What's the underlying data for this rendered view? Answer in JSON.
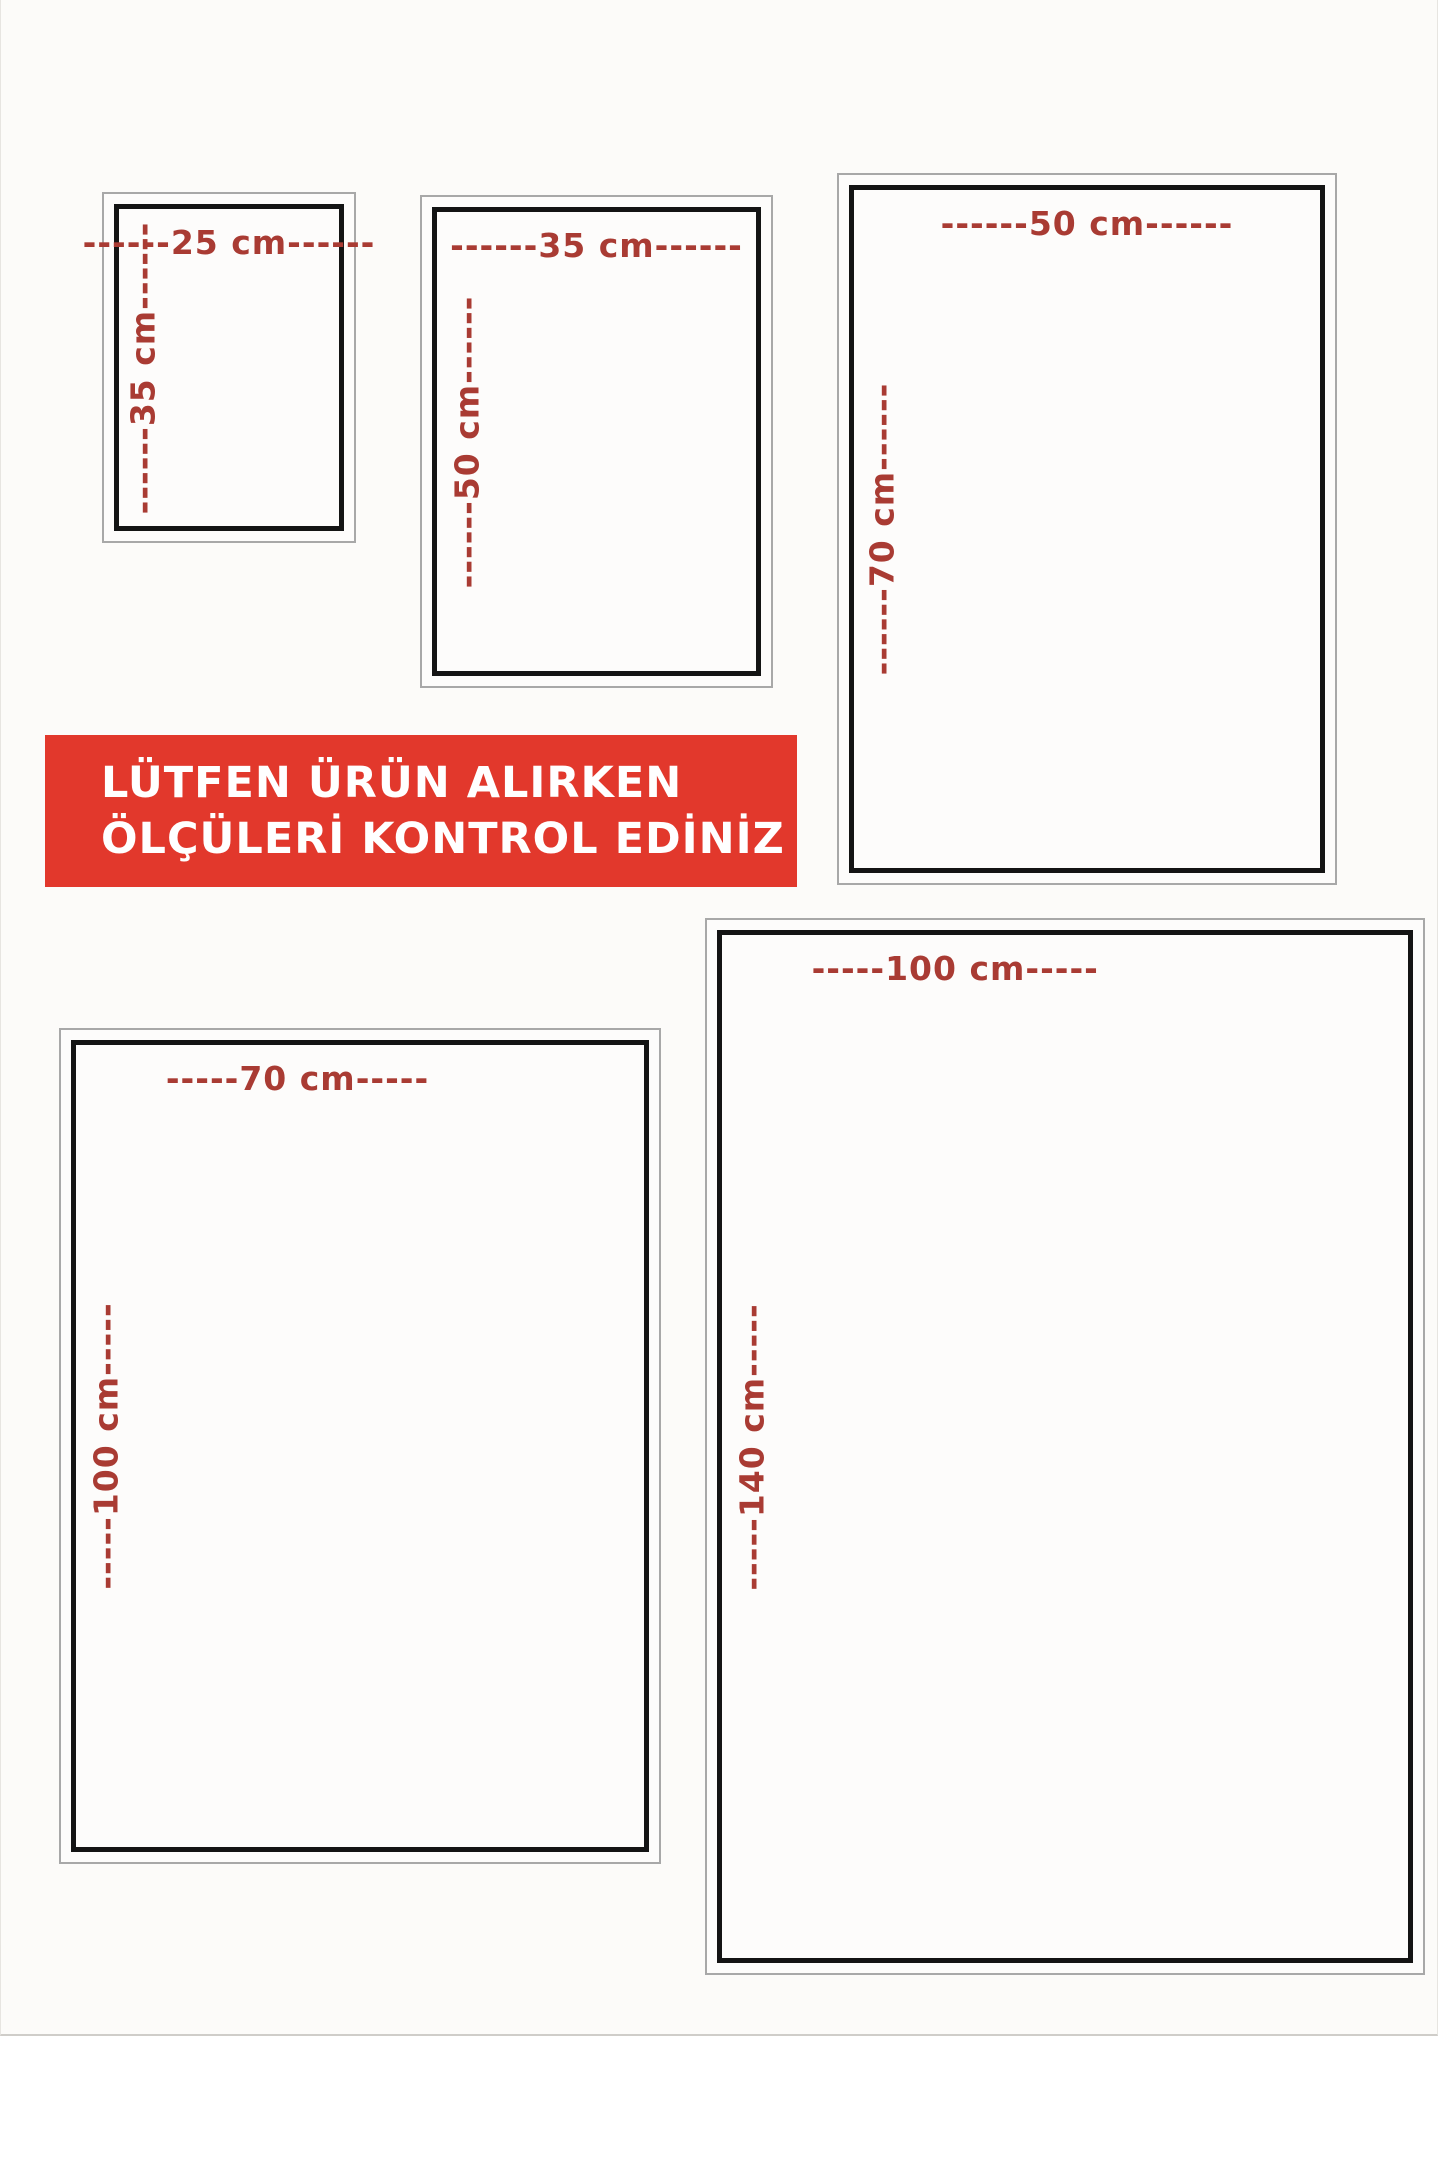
{
  "banner": {
    "line1": "LÜTFEN ÜRÜN ALIRKEN",
    "line2": "ÖLÇÜLERİ KONTROL EDİNİZ"
  },
  "colors": {
    "banner_red": "#e2382c",
    "banner_text": "#ffffff",
    "label_red": "#a93b33",
    "box_border_black": "#141414",
    "box_frame_gray": "#a8a8a8",
    "page_bg": "#fcfbf9"
  },
  "sizes": [
    {
      "name": "25x35",
      "width_cm": 25,
      "height_cm": 35,
      "width_label": "------25 cm------",
      "height_label": "------35 cm------"
    },
    {
      "name": "35x50",
      "width_cm": 35,
      "height_cm": 50,
      "width_label": "------35 cm------",
      "height_label": "------50 cm------"
    },
    {
      "name": "50x70",
      "width_cm": 50,
      "height_cm": 70,
      "width_label": "------50 cm------",
      "height_label": "------70 cm------"
    },
    {
      "name": "70x100",
      "width_cm": 70,
      "height_cm": 100,
      "width_label": "-----70 cm-----",
      "height_label": "-----100 cm-----"
    },
    {
      "name": "100x140",
      "width_cm": 100,
      "height_cm": 140,
      "width_label": "-----100 cm-----",
      "height_label": "-----140 cm-----"
    }
  ]
}
